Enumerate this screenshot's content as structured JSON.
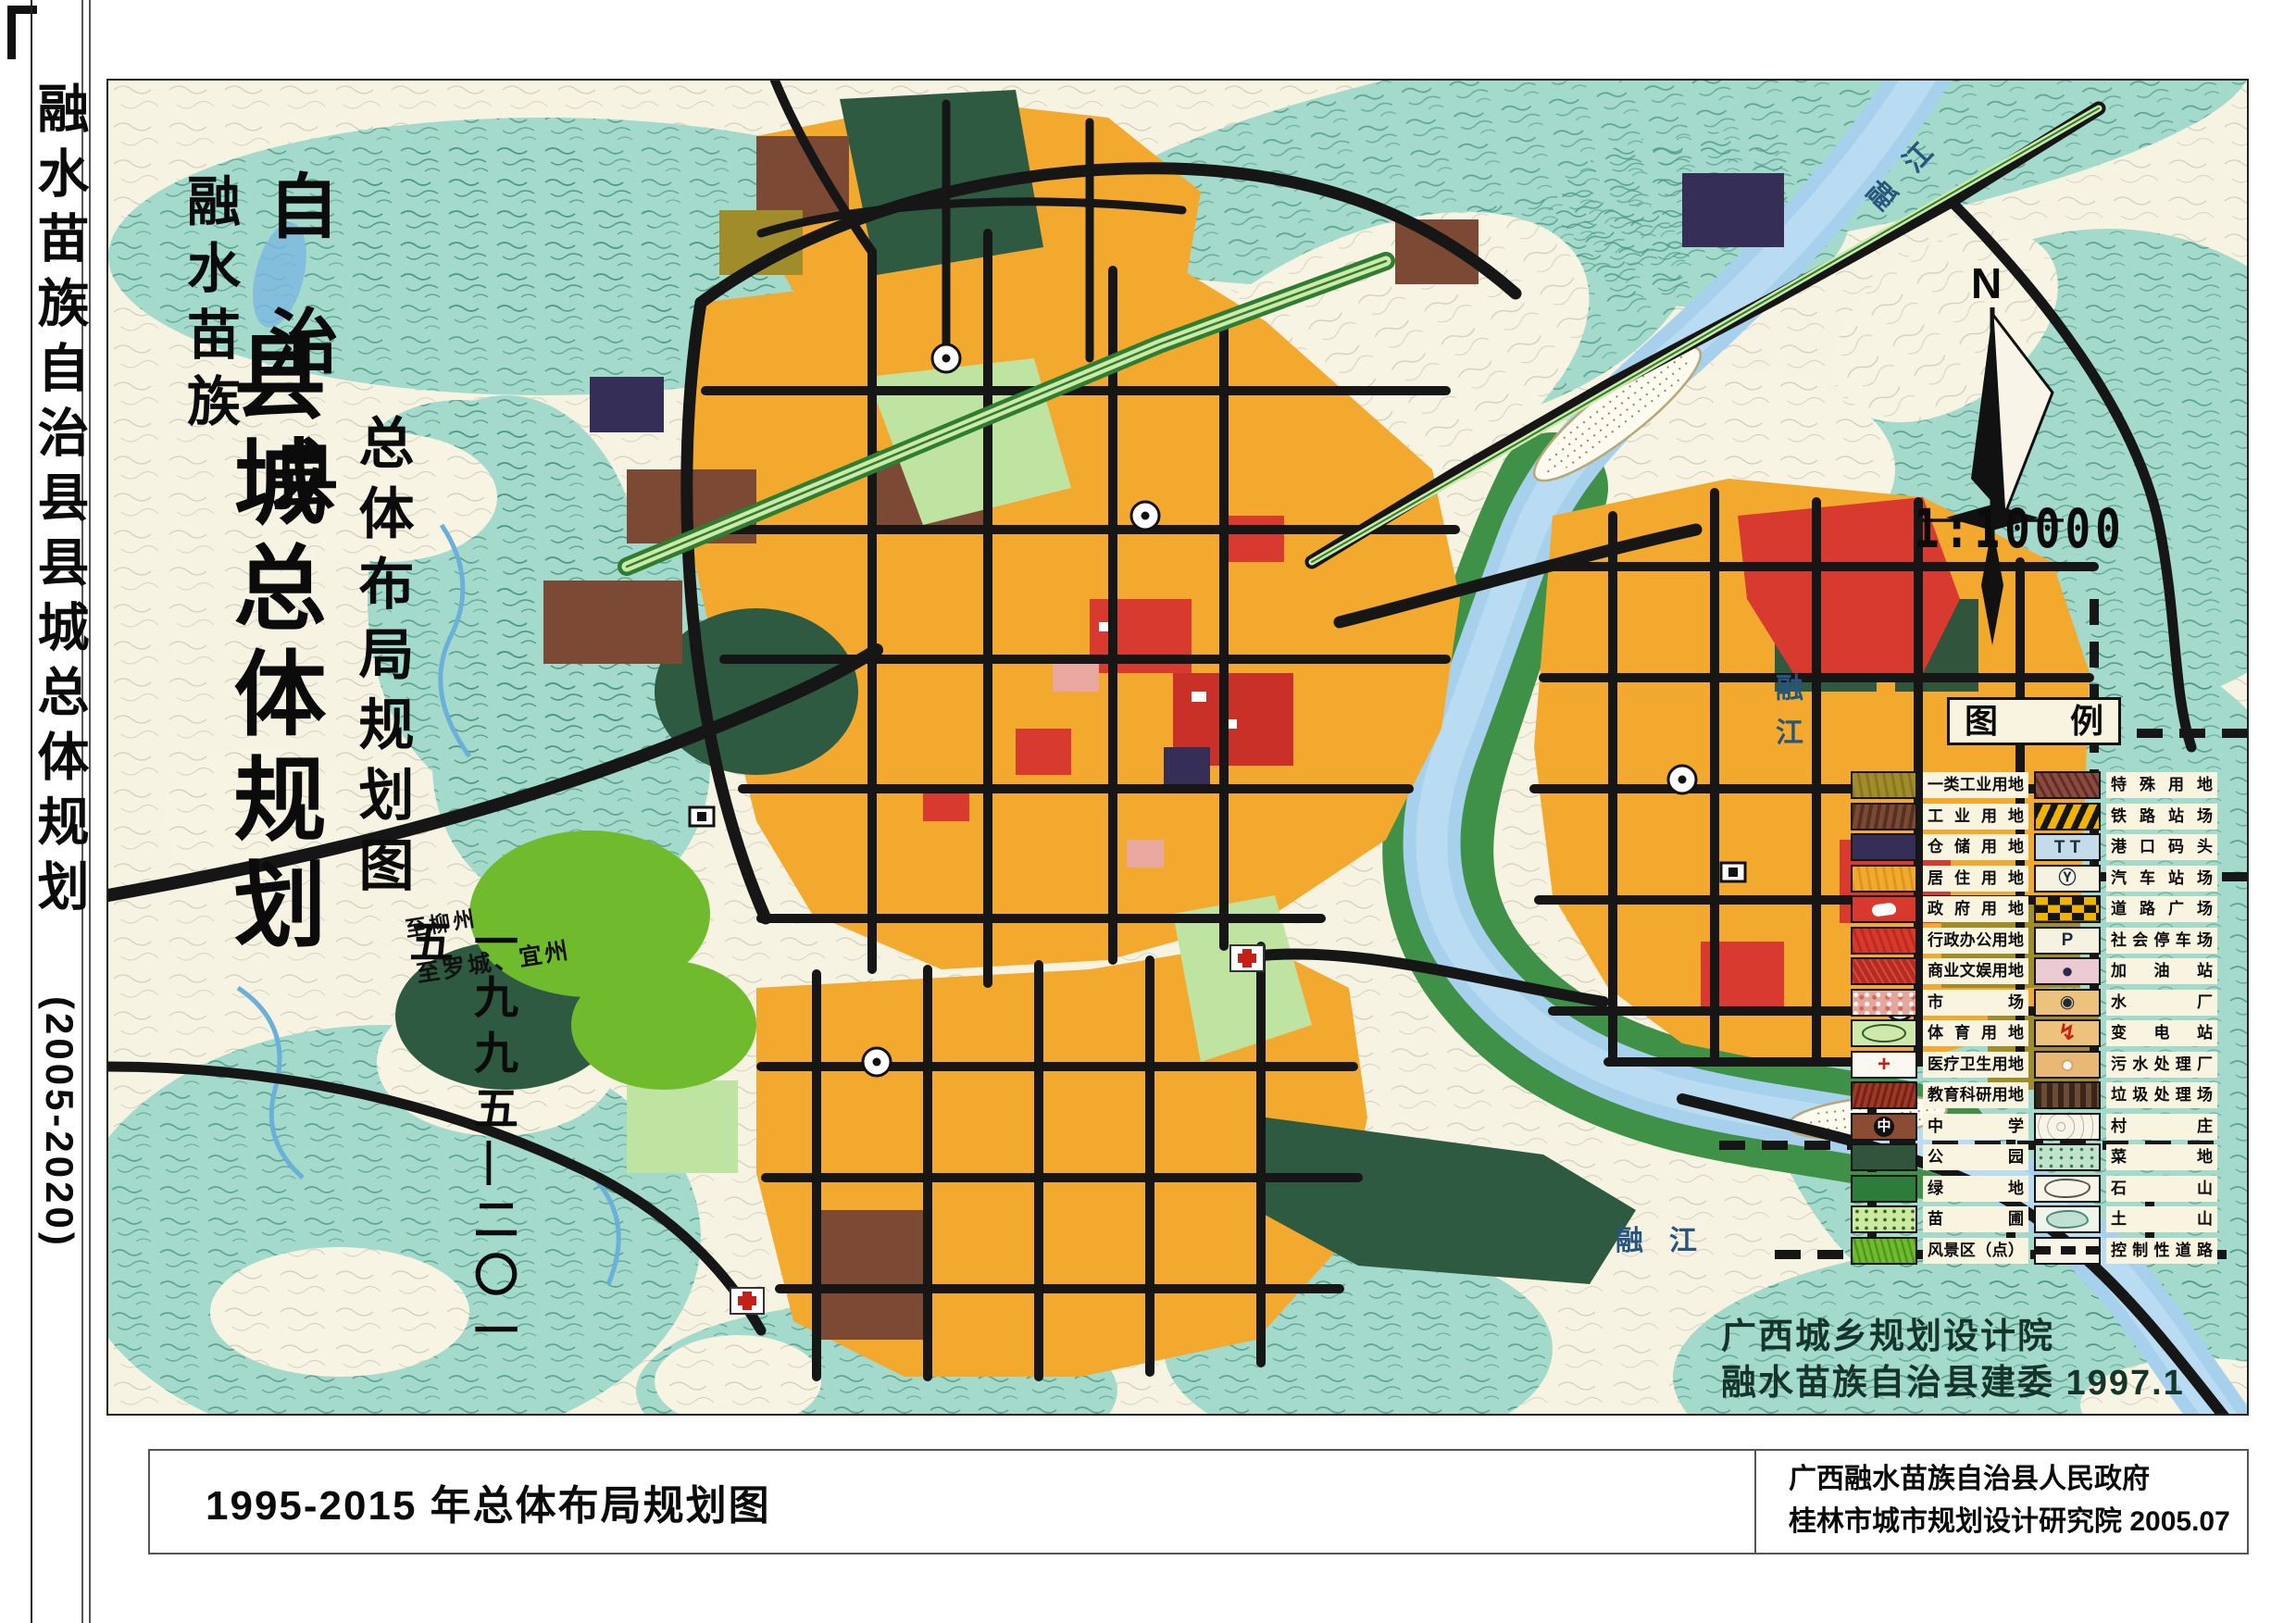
{
  "sidebar": {
    "title": "融水苗族自治县县城总体规划",
    "period": "(2005-2020)"
  },
  "map": {
    "title_group": {
      "pre1": "融水苗族",
      "pre2": "自治县",
      "main": "县城总体规划",
      "subtitle": "总体布局规划图",
      "period": "一九九五—二〇一五"
    },
    "compass": {
      "north": "N",
      "scale": "1:10000"
    },
    "river_label": "融江",
    "road_labels": {
      "to_liuzhou": "至柳州",
      "to_luocheng": "至罗城、宜州"
    },
    "credit": {
      "line1": "广西城乡规划设计院",
      "line2": "融水苗族自治县建委 1997.1"
    }
  },
  "legend": {
    "title": "图例",
    "rows": [
      {
        "left": {
          "label": "一类工业用地",
          "swatch": "sw-olive"
        },
        "right": {
          "label": "特殊用地",
          "swatch": "sw-special"
        }
      },
      {
        "left": {
          "label": "工业用地",
          "swatch": "sw-industry"
        },
        "right": {
          "label": "铁路站场",
          "swatch": "sw-rail"
        }
      },
      {
        "left": {
          "label": "仓储用地",
          "swatch": "sw-warehouse"
        },
        "right": {
          "label": "港口码头",
          "swatch": "sw-port",
          "glyph": "T T",
          "glyph_class": "g-dark"
        }
      },
      {
        "left": {
          "label": "居住用地",
          "swatch": "sw-resid"
        },
        "right": {
          "label": "汽车站场",
          "swatch": "sw-bus",
          "glyph": "Ⓨ",
          "glyph_class": "g-dark"
        }
      },
      {
        "left": {
          "label": "政府用地",
          "swatch": "sw-gov"
        },
        "right": {
          "label": "道路广场",
          "swatch": "sw-plaza"
        }
      },
      {
        "left": {
          "label": "行政办公用地",
          "swatch": "sw-admin"
        },
        "right": {
          "label": "社会停车场",
          "swatch": "sw-parklot",
          "glyph": "P",
          "glyph_class": "g-dark"
        }
      },
      {
        "left": {
          "label": "商业文娱用地",
          "swatch": "sw-commerce"
        },
        "right": {
          "label": "加油站",
          "swatch": "sw-gas",
          "glyph": "●",
          "glyph_class": "g-navy"
        }
      },
      {
        "left": {
          "label": "市场",
          "swatch": "sw-market"
        },
        "right": {
          "label": "水厂",
          "swatch": "sw-water",
          "glyph": "◉",
          "glyph_class": "g-dark"
        }
      },
      {
        "left": {
          "label": "体育用地",
          "swatch": "sw-sport"
        },
        "right": {
          "label": "变电站",
          "swatch": "sw-elec",
          "glyph": "↯",
          "glyph_class": "g-redbold"
        }
      },
      {
        "left": {
          "label": "医疗卫生用地",
          "swatch": "sw-medical",
          "glyph": "+",
          "glyph_class": "g-redbold"
        },
        "right": {
          "label": "污水处理厂",
          "swatch": "sw-sewage",
          "glyph": "●",
          "glyph_class": "g-whitecirc"
        }
      },
      {
        "left": {
          "label": "教育科研用地",
          "swatch": "sw-edu"
        },
        "right": {
          "label": "垃圾处理场",
          "swatch": "sw-trash"
        }
      },
      {
        "left": {
          "label": "中学",
          "swatch": "sw-middle",
          "glyph": "中",
          "glyph_class": "g-circled"
        },
        "right": {
          "label": "村庄",
          "swatch": "sw-village"
        }
      },
      {
        "left": {
          "label": "公园",
          "swatch": "sw-park"
        },
        "right": {
          "label": "菜地",
          "swatch": "sw-veg"
        }
      },
      {
        "left": {
          "label": "绿地",
          "swatch": "sw-green"
        },
        "right": {
          "label": "石山",
          "swatch": "sw-rock"
        }
      },
      {
        "left": {
          "label": "苗圃",
          "swatch": "sw-nursery"
        },
        "right": {
          "label": "土山",
          "swatch": "sw-earth"
        }
      },
      {
        "left": {
          "label": "风景区（点）",
          "swatch": "sw-scenic"
        },
        "right": {
          "label": "控制性道路",
          "swatch": "sw-ctrl"
        }
      }
    ]
  },
  "footer": {
    "caption": "1995-2015 年总体布局规划图",
    "org_line1": "广西融水苗族自治县人民政府",
    "org_line2": "桂林市城市规划设计研究院  2005.07"
  },
  "colors": {
    "residential_orange": "#f2a92e",
    "admin_red": "#d8392c",
    "industry_brown": "#7c4a34",
    "park_dark_green": "#2d5a40",
    "green_space": "#2e7c3a",
    "river_blue": "#a6d0ec",
    "terrain_teal": "#a3dacb",
    "road_black": "#141414",
    "paper_cream": "#f7f3e2"
  }
}
